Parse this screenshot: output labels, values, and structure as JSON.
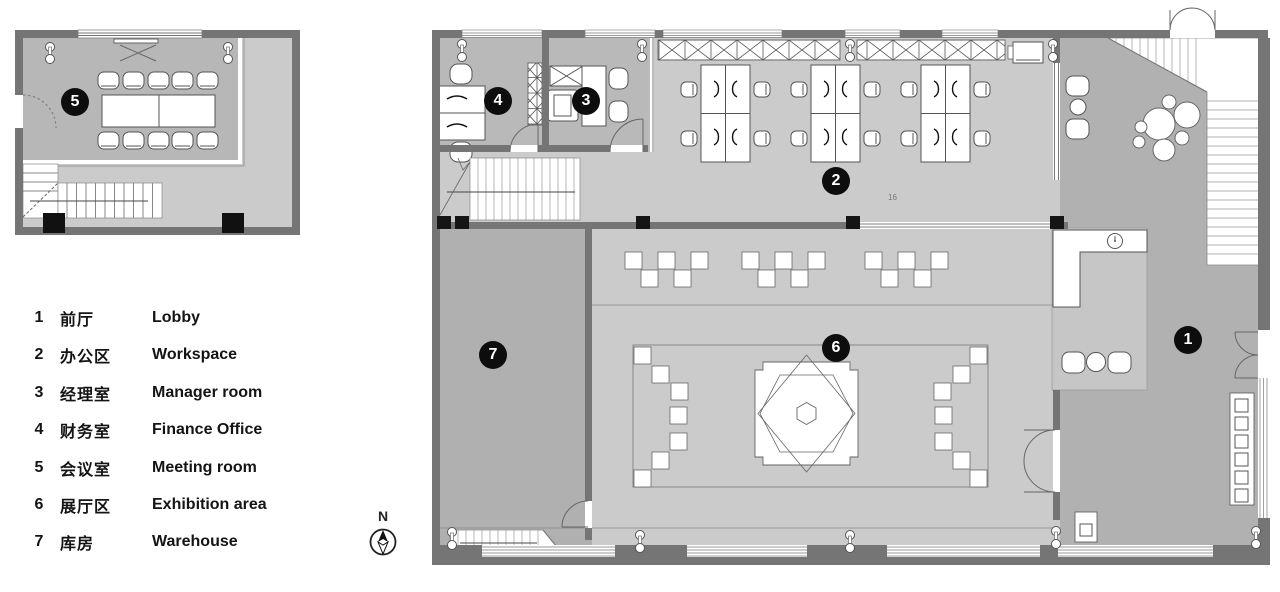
{
  "legend": {
    "items": [
      {
        "num": "1",
        "zh": "前厅",
        "en": "Lobby"
      },
      {
        "num": "2",
        "zh": "办公区",
        "en": "Workspace"
      },
      {
        "num": "3",
        "zh": "经理室",
        "en": "Manager room"
      },
      {
        "num": "4",
        "zh": "财务室",
        "en": "Finance Office"
      },
      {
        "num": "5",
        "zh": "会议室",
        "en": "Meeting room"
      },
      {
        "num": "6",
        "zh": "展厅区",
        "en": "Exhibition area"
      },
      {
        "num": "7",
        "zh": "库房",
        "en": "Warehouse"
      }
    ]
  },
  "badges": [
    {
      "label": "1",
      "room": "lobby"
    },
    {
      "label": "2",
      "room": "workspace"
    },
    {
      "label": "3",
      "room": "manager-room"
    },
    {
      "label": "4",
      "room": "finance-office"
    },
    {
      "label": "5",
      "room": "meeting-room"
    },
    {
      "label": "6",
      "room": "exhibition-area"
    },
    {
      "label": "7",
      "room": "warehouse"
    }
  ],
  "north": {
    "label": "N"
  },
  "main_plan": {
    "stair_note": "16"
  },
  "colors": {
    "wall": "#757575",
    "floor_light": "#cbcbcb",
    "floor_mid": "#b9b9b9",
    "floor_dark": "#b0b0b0",
    "alcove": "#c6c6c6",
    "badge_bg": "#0d0d0d",
    "badge_text": "#ffffff",
    "line": "#555555"
  }
}
